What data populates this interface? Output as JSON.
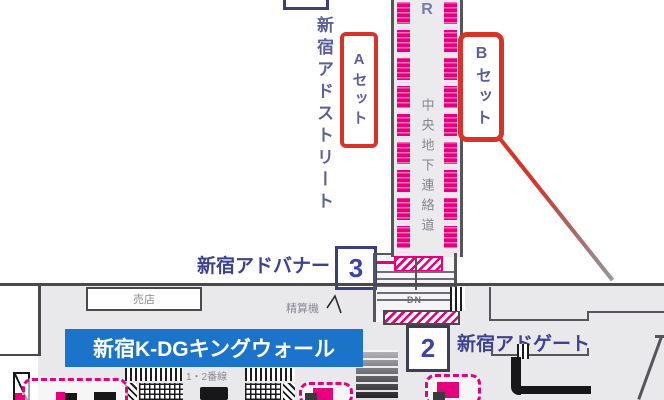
{
  "labels": {
    "ad_street": "新宿アドストリート",
    "set_a": "Aセット",
    "set_b": "Bセット",
    "route_letter": "R",
    "corridor": "中央地下連絡道",
    "ad_banner": "新宿アドバナー",
    "ad_banner_no": "3",
    "kiosk": "売店",
    "fare_machine": "精算機",
    "king_wall": "新宿K-DGキングウォール",
    "platforms": "1・2番線",
    "down": "DN",
    "ad_gate_no": "2",
    "ad_gate": "新宿アドゲート"
  },
  "colors": {
    "ad_magenta": "#e6007e",
    "highlight_red": "#d93228",
    "label_navy": "#3f4291",
    "number_blue": "#3b44a0",
    "banner_blue": "#1b74c9",
    "wall_gray": "#4a4a4c",
    "text_gray": "#8a8a94"
  }
}
